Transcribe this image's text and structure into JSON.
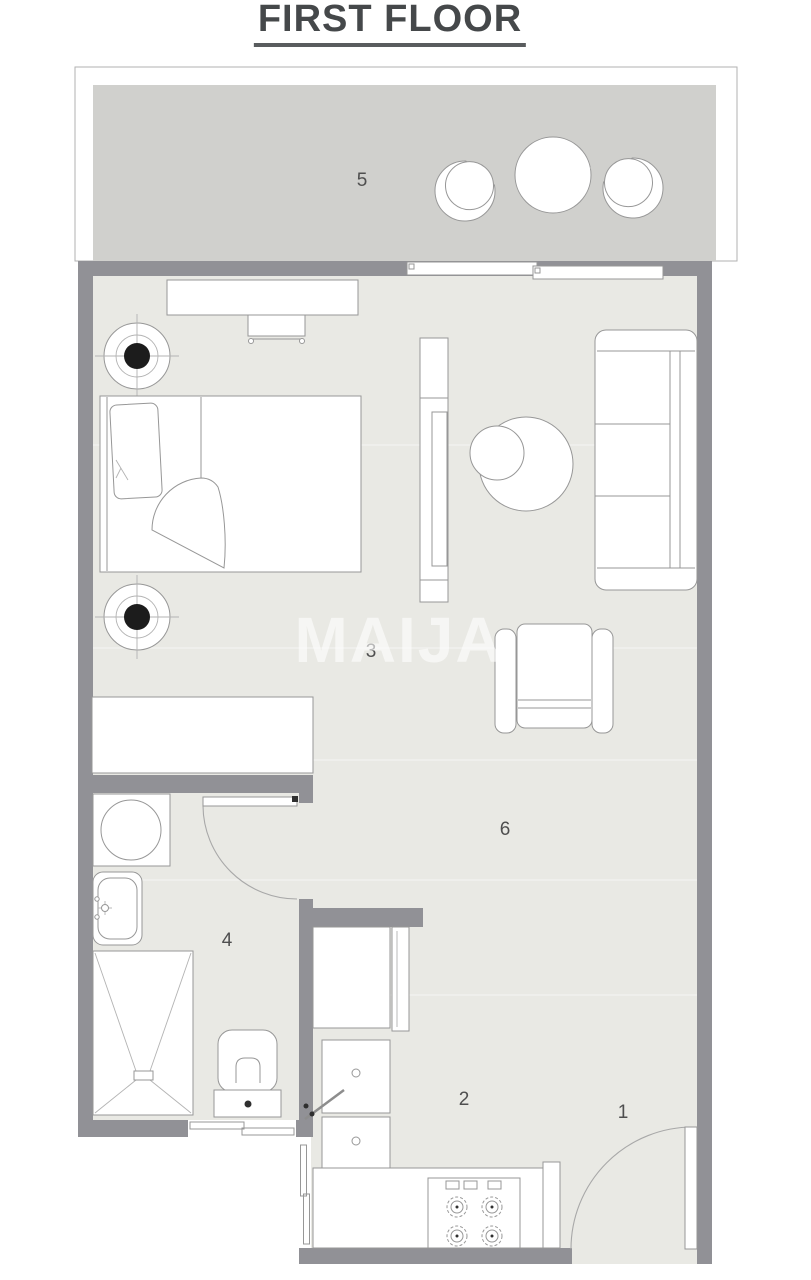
{
  "title": "FIRST FLOOR",
  "watermark": "MAIJA",
  "room_labels": [
    {
      "room": "entrance",
      "number": "1"
    },
    {
      "room": "kitchen",
      "number": "2"
    },
    {
      "room": "bedroom",
      "number": "3"
    },
    {
      "room": "bathroom",
      "number": "4"
    },
    {
      "room": "balcony",
      "number": "5"
    },
    {
      "room": "living-area",
      "number": "6"
    }
  ],
  "colors": {
    "wall": "#919196",
    "floor": "#e9e9e4",
    "balcony_floor": "#d0d0cd",
    "outline": "#979797",
    "label_text": "#4f4f4f",
    "title_text": "#45484a",
    "watermark_color": "rgba(255,255,255,0.60)"
  }
}
